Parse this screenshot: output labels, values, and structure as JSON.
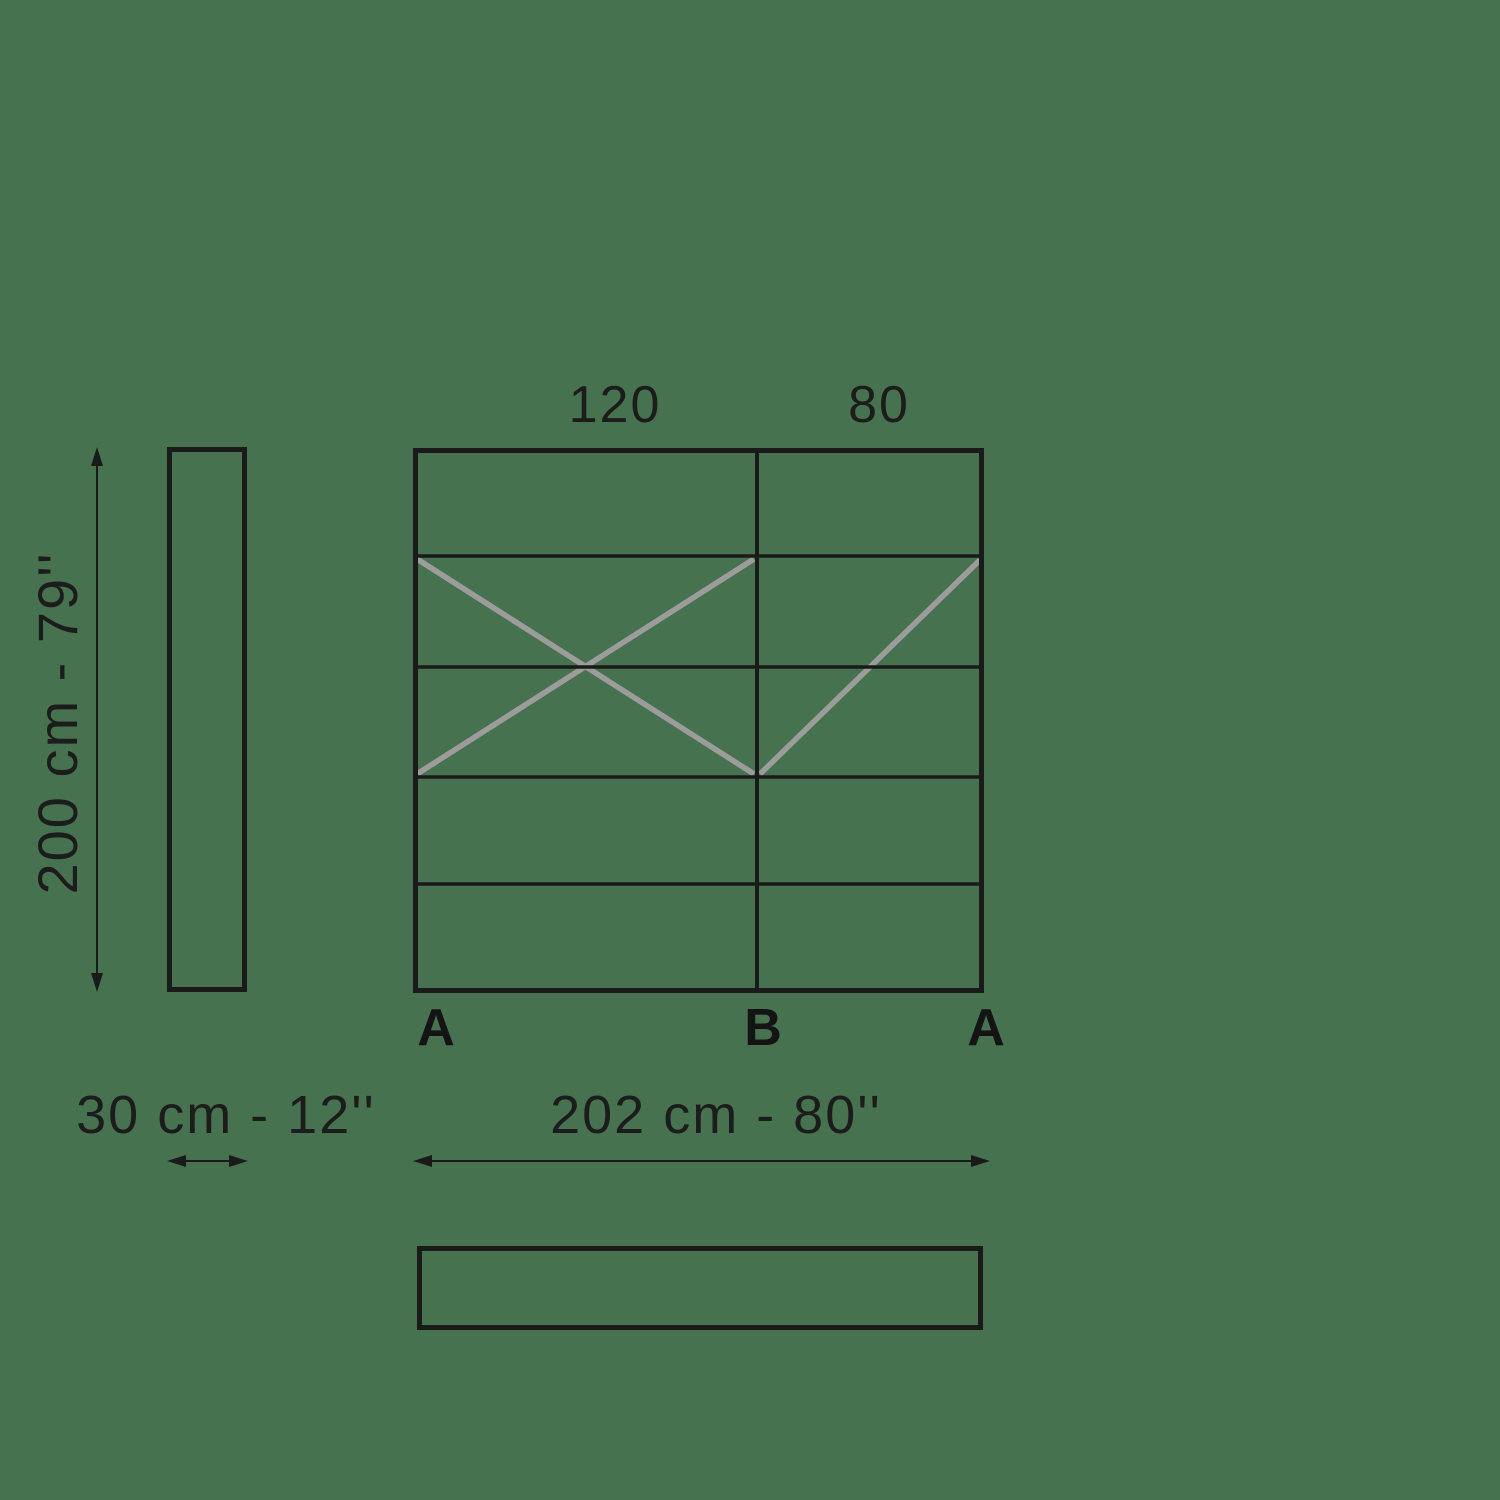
{
  "colors": {
    "background": "#47724F",
    "line": "#1a1a1a",
    "diagonal": "#9c9c9c",
    "text": "#1c1c1c"
  },
  "front_view": {
    "column_width_labels": [
      "120",
      "80"
    ],
    "section_markers": [
      "A",
      "B",
      "A"
    ]
  },
  "dimension_labels": {
    "height": "200 cm - 79''",
    "depth": "30 cm - 12''",
    "width": "202 cm - 80''"
  }
}
